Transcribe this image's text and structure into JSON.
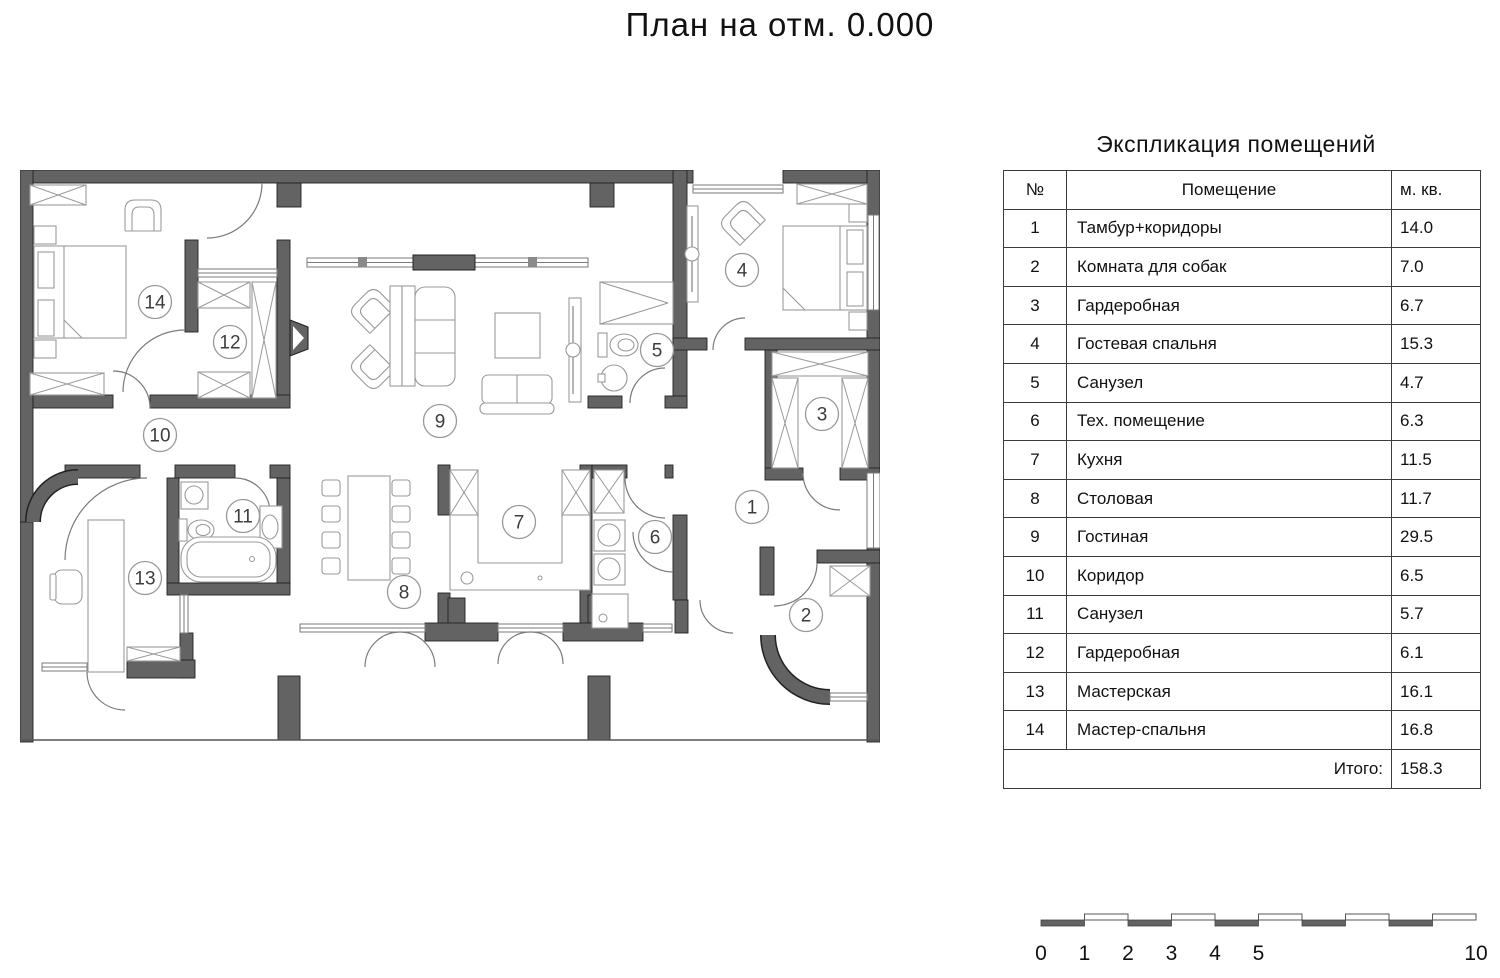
{
  "page_title": "План на отм. 0.000",
  "explication": {
    "title": "Экспликация помещений",
    "headers": {
      "num": "№",
      "name": "Помещение",
      "area": "м. кв."
    },
    "rows": [
      {
        "num": "1",
        "name": "Тамбур+коридоры",
        "area": "14.0"
      },
      {
        "num": "2",
        "name": "Комната для собак",
        "area": "7.0"
      },
      {
        "num": "3",
        "name": "Гардеробная",
        "area": "6.7"
      },
      {
        "num": "4",
        "name": "Гостевая спальня",
        "area": "15.3"
      },
      {
        "num": "5",
        "name": "Санузел",
        "area": "4.7"
      },
      {
        "num": "6",
        "name": "Тех. помещение",
        "area": "6.3"
      },
      {
        "num": "7",
        "name": "Кухня",
        "area": "11.5"
      },
      {
        "num": "8",
        "name": "Столовая",
        "area": "11.7"
      },
      {
        "num": "9",
        "name": "Гостиная",
        "area": "29.5"
      },
      {
        "num": "10",
        "name": "Коридор",
        "area": "6.5"
      },
      {
        "num": "11",
        "name": "Санузел",
        "area": "5.7"
      },
      {
        "num": "12",
        "name": "Гардеробная",
        "area": "6.1"
      },
      {
        "num": "13",
        "name": "Мастерская",
        "area": "16.1"
      },
      {
        "num": "14",
        "name": "Мастер-спальня",
        "area": "16.8"
      }
    ],
    "total_label": "Итого:",
    "total_value": "158.3"
  },
  "plan": {
    "rooms": [
      {
        "num": "1",
        "name": "Тамбур+коридоры",
        "x": 732,
        "y": 337
      },
      {
        "num": "2",
        "name": "Комната для собак",
        "x": 786,
        "y": 445
      },
      {
        "num": "3",
        "name": "Гардеробная",
        "x": 802,
        "y": 244
      },
      {
        "num": "4",
        "name": "Гостевая спальня",
        "x": 722,
        "y": 100
      },
      {
        "num": "5",
        "name": "Санузел",
        "x": 637,
        "y": 180
      },
      {
        "num": "6",
        "name": "Тех. помещение",
        "x": 635,
        "y": 367
      },
      {
        "num": "7",
        "name": "Кухня",
        "x": 499,
        "y": 352
      },
      {
        "num": "8",
        "name": "Столовая",
        "x": 384,
        "y": 422
      },
      {
        "num": "9",
        "name": "Гостиная",
        "x": 420,
        "y": 251
      },
      {
        "num": "10",
        "name": "Коридор",
        "x": 140,
        "y": 265
      },
      {
        "num": "11",
        "name": "Санузел",
        "x": 223,
        "y": 346
      },
      {
        "num": "12",
        "name": "Гардеробная",
        "x": 210,
        "y": 172
      },
      {
        "num": "13",
        "name": "Мастерская",
        "x": 125,
        "y": 408
      },
      {
        "num": "14",
        "name": "Мастер-спальня",
        "x": 135,
        "y": 132
      }
    ]
  },
  "scalebar": {
    "units": 10,
    "unit_labels": [
      "0",
      "1",
      "2",
      "3",
      "4",
      "5"
    ],
    "end_label": "10"
  },
  "colors": {
    "wall": "#636363",
    "wall_edge": "#222222",
    "thin_line": "#7a7a7a",
    "furniture_line": "#9a9a9a",
    "text": "#1a1a1a"
  }
}
